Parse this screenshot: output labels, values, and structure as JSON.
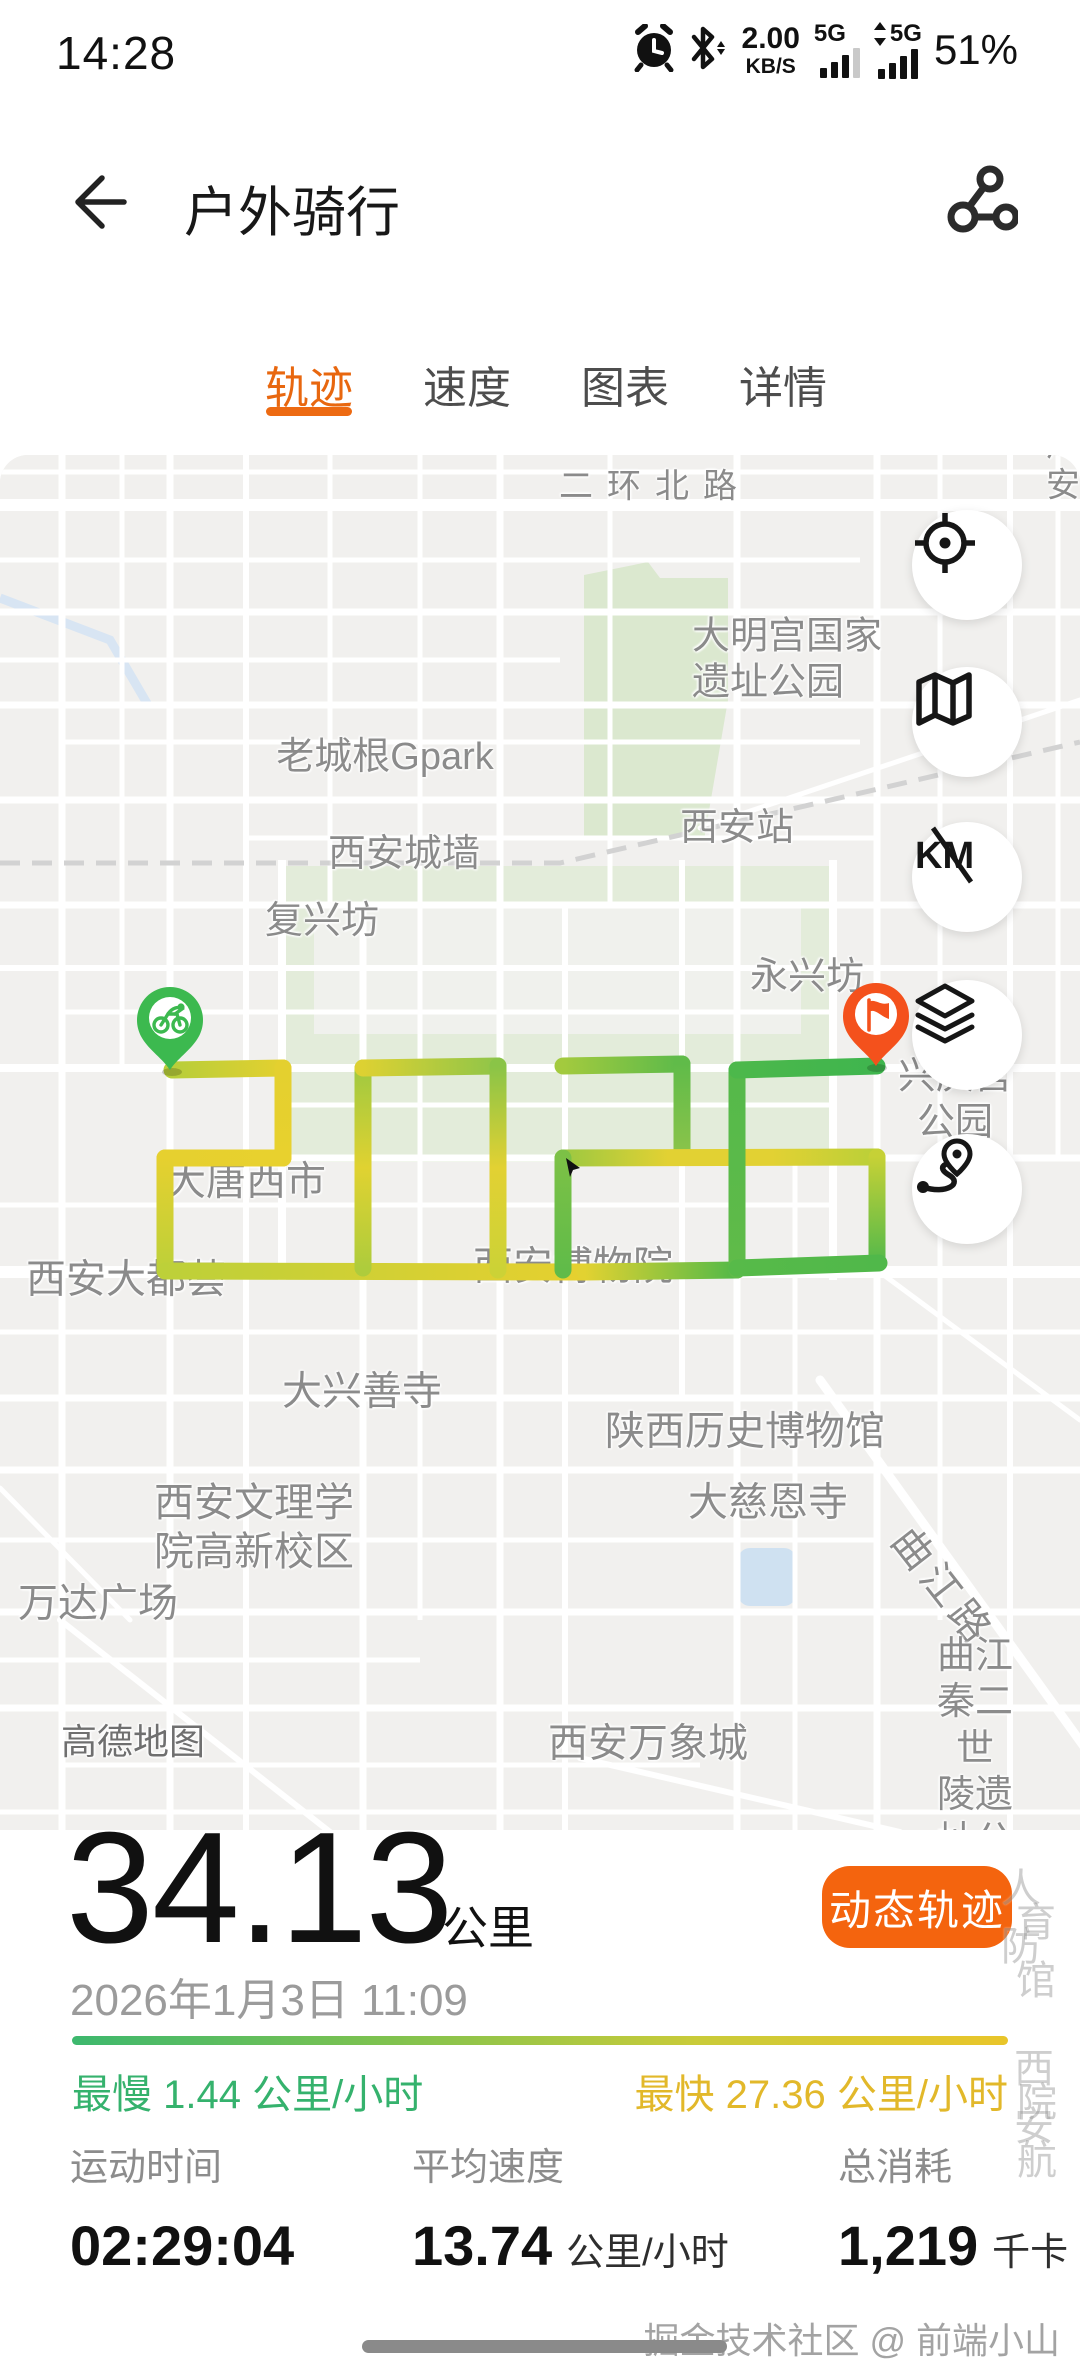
{
  "status_bar": {
    "time": "14:28",
    "net_speed": "2.00",
    "net_speed_unit": "KB/S",
    "sim1_network": "5G",
    "sim2_network": "5G",
    "battery": "51%"
  },
  "header": {
    "title": "户外骑行"
  },
  "tabs": [
    {
      "label": "轨迹",
      "active": true
    },
    {
      "label": "速度",
      "active": false
    },
    {
      "label": "图表",
      "active": false
    },
    {
      "label": "详情",
      "active": false
    }
  ],
  "map": {
    "attribution": "高德地图",
    "route_digits": "2026",
    "labels": [
      {
        "text": "二环北路",
        "x": 655,
        "y": 487,
        "size": 34,
        "ls": 14
      },
      {
        "text": "广安",
        "x": 1068,
        "y": 466,
        "size": 34,
        "ls": 10
      },
      {
        "text": "大明宫国家\n遗址公园",
        "x": 692,
        "y": 660,
        "size": 38,
        "align": "left"
      },
      {
        "text": "老城根Gpark",
        "x": 385,
        "y": 757,
        "size": 38
      },
      {
        "text": "西安站",
        "x": 737,
        "y": 828,
        "size": 38
      },
      {
        "text": "西安城墙",
        "x": 404,
        "y": 854,
        "size": 38
      },
      {
        "text": "复兴坊",
        "x": 322,
        "y": 921,
        "size": 38
      },
      {
        "text": "永兴坊",
        "x": 807,
        "y": 977,
        "size": 38
      },
      {
        "text": "兴庆宫公园",
        "x": 955,
        "y": 1100,
        "size": 38
      },
      {
        "text": "大唐西市",
        "x": 246,
        "y": 1182,
        "size": 40
      },
      {
        "text": "西安大都荟",
        "x": 126,
        "y": 1280,
        "size": 40
      },
      {
        "text": "西安博物院",
        "x": 573,
        "y": 1267,
        "size": 40
      },
      {
        "text": "大兴善寺",
        "x": 362,
        "y": 1392,
        "size": 40
      },
      {
        "text": "陕西历史博物馆",
        "x": 745,
        "y": 1432,
        "size": 40
      },
      {
        "text": "大慈恩寺",
        "x": 768,
        "y": 1503,
        "size": 40
      },
      {
        "text": "西安文理学\n院高新校区",
        "x": 254,
        "y": 1528,
        "size": 40
      },
      {
        "text": "万达广场",
        "x": 98,
        "y": 1604,
        "size": 40
      },
      {
        "text": "曲江路",
        "x": 942,
        "y": 1588,
        "size": 40,
        "rotate": 52,
        "ls": 6
      },
      {
        "text": "西安万象城",
        "x": 648,
        "y": 1744,
        "size": 40
      },
      {
        "text": "曲江秦二世\n陵遗址公园",
        "x": 975,
        "y": 1772,
        "size": 38
      },
      {
        "text": "高德地图",
        "x": 133,
        "y": 1742,
        "size": 36,
        "color": "#6f6f6f"
      }
    ],
    "controls": [
      {
        "icon": "locate-icon"
      },
      {
        "icon": "map-style-icon"
      },
      {
        "icon": "km-markers-icon"
      },
      {
        "icon": "layers-icon"
      },
      {
        "icon": "route-overview-icon"
      }
    ],
    "route_segments": [
      {
        "line": [
          172,
          1070,
          283,
          1068
        ],
        "stops": [
          "#b7ce3a",
          "#e4d02f"
        ]
      },
      {
        "line": [
          283,
          1068,
          283,
          1158
        ],
        "stops": [
          "#e4d02f",
          "#e8d12e"
        ]
      },
      {
        "line": [
          283,
          1158,
          165,
          1158
        ],
        "stops": [
          "#e8d12e",
          "#e6d02f"
        ]
      },
      {
        "line": [
          165,
          1158,
          165,
          1270
        ],
        "stops": [
          "#e6d02f",
          "#bdd039"
        ]
      },
      {
        "line": [
          165,
          1271,
          585,
          1272
        ],
        "stops": [
          "#bdd039",
          "#e6d02f"
        ]
      },
      {
        "line": [
          585,
          1272,
          737,
          1270
        ],
        "stops": [
          "#e2d231",
          "#52b948"
        ]
      },
      {
        "line": [
          363,
          1268,
          363,
          1068
        ],
        "stops": [
          "#aecc3c",
          "#e0d231",
          "#a0c940"
        ]
      },
      {
        "line": [
          363,
          1068,
          498,
          1066
        ],
        "stops": [
          "#ddd132",
          "#8fc549"
        ]
      },
      {
        "line": [
          498,
          1066,
          498,
          1270
        ],
        "stops": [
          "#8ac447",
          "#e2d133",
          "#ccd236"
        ]
      },
      {
        "line": [
          563,
          1066,
          682,
          1064
        ],
        "stops": [
          "#a3ca3e",
          "#5cba4a"
        ]
      },
      {
        "line": [
          682,
          1064,
          682,
          1157
        ],
        "stops": [
          "#60bb49",
          "#8cc44a"
        ]
      },
      {
        "line": [
          563,
          1158,
          877,
          1157
        ],
        "stops": [
          "#9cc841",
          "#e2d133",
          "#e2d133",
          "#bad038"
        ]
      },
      {
        "line": [
          563,
          1158,
          563,
          1270
        ],
        "stops": [
          "#7cc146",
          "#60bb49"
        ]
      },
      {
        "line": [
          737,
          1070,
          737,
          1270
        ],
        "stops": [
          "#55b94a",
          "#60bb49"
        ]
      },
      {
        "line": [
          737,
          1070,
          877,
          1066
        ],
        "stops": [
          "#4cb84b",
          "#3fb54e"
        ]
      },
      {
        "line": [
          877,
          1157,
          877,
          1262
        ],
        "stops": [
          "#c6d136",
          "#55b94a"
        ]
      },
      {
        "line": [
          737,
          1268,
          879,
          1263
        ],
        "stops": [
          "#57ba49",
          "#50b84a"
        ]
      }
    ],
    "bleed_labels": [
      {
        "text": "人防",
        "x": 1041,
        "y": 1878
      },
      {
        "text": "育馆",
        "x": 1056,
        "y": 1912
      },
      {
        "text": "西安",
        "x": 1054,
        "y": 2058
      },
      {
        "text": "院航",
        "x": 1057,
        "y": 2092
      }
    ]
  },
  "summary": {
    "distance": "34.13",
    "distance_unit": "公里",
    "action_button": "动态轨迹",
    "datetime": "2026年1月3日 11:09",
    "min_label": "最慢",
    "min_value": "1.44",
    "min_unit": "公里/小时",
    "max_label": "最快",
    "max_value": "27.36",
    "max_unit": "公里/小时"
  },
  "metrics": [
    {
      "label": "运动时间",
      "value": "02:29:04",
      "unit": ""
    },
    {
      "label": "平均速度",
      "value": "13.74",
      "unit": "公里/小时"
    },
    {
      "label": "总消耗",
      "value": "1,219",
      "unit": "千卡"
    }
  ],
  "footer": {
    "watermark": "掘金技术社区 @ 前端小山"
  },
  "colors": {
    "accent_orange": "#f4640e",
    "tab_active": "#e8670f",
    "route_green": "#4db84c",
    "route_yellow": "#e6d130",
    "slow_green": "#35b26d",
    "fast_yellow": "#e2b82a",
    "pin_start_green": "#3cb94f",
    "pin_end_orange": "#f4511c"
  }
}
